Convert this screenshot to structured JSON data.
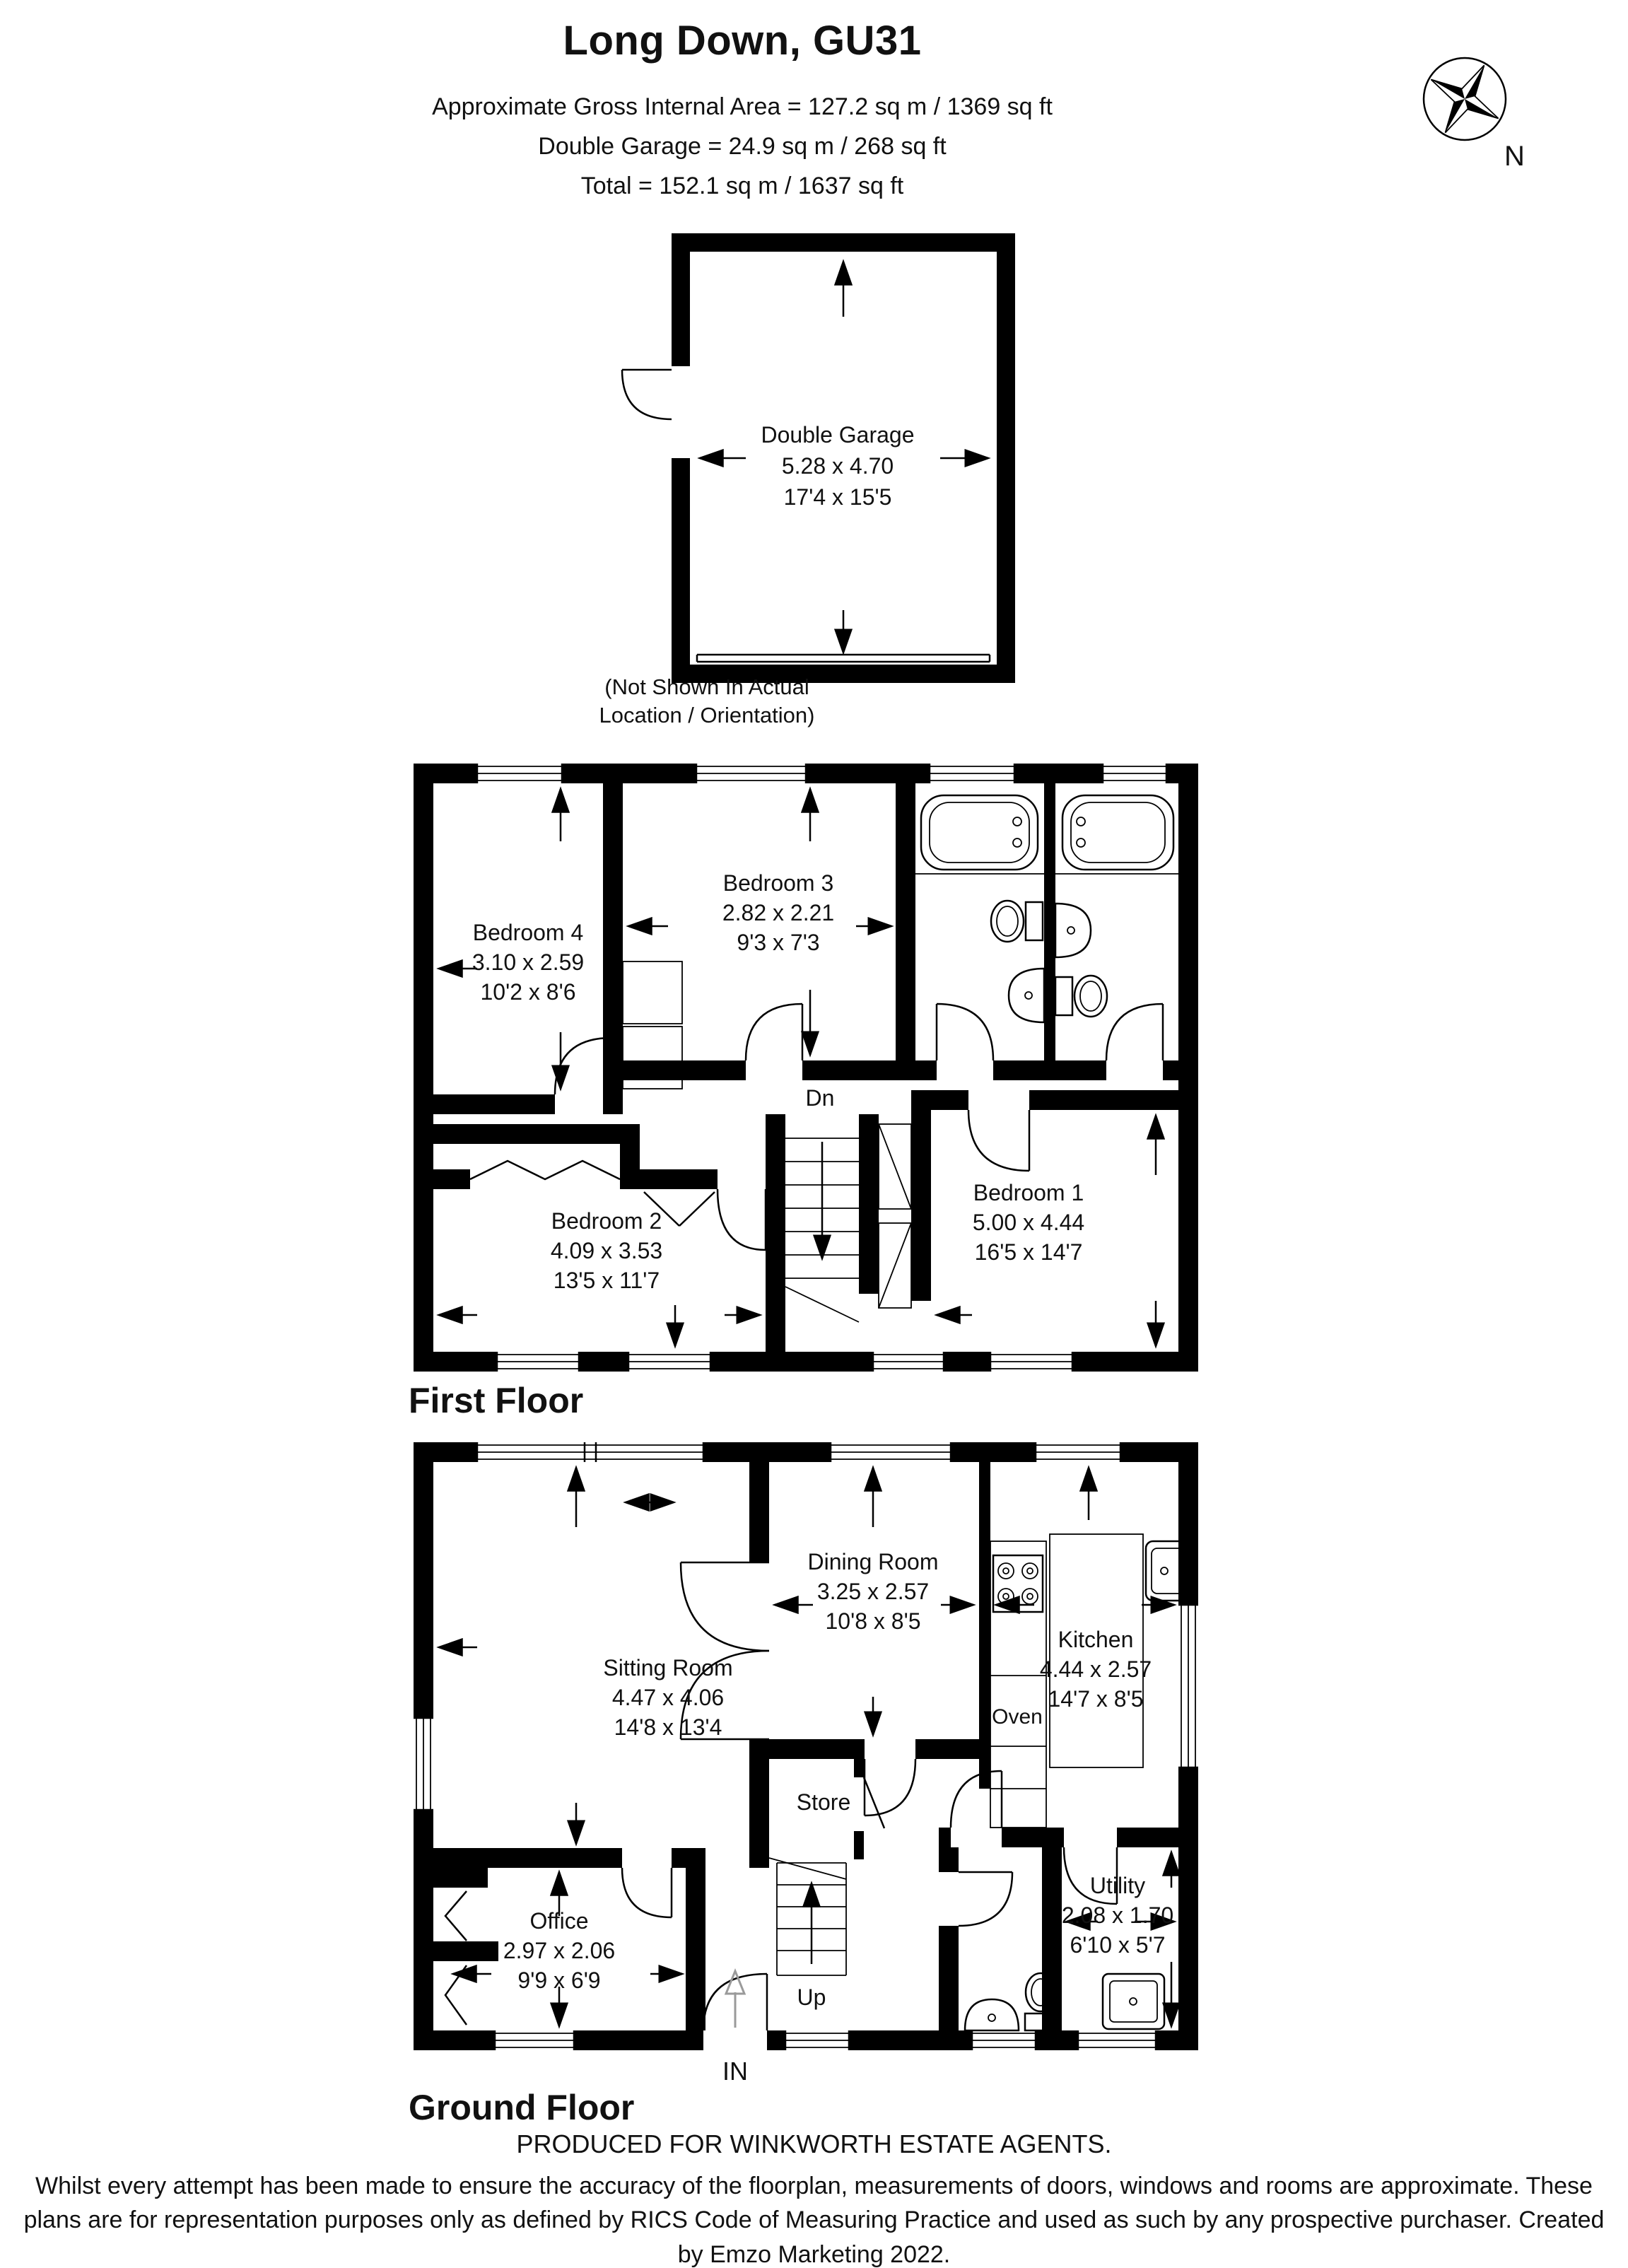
{
  "header": {
    "title": "Long Down, GU31",
    "line1": "Approximate Gross Internal Area = 127.2 sq m / 1369 sq ft",
    "line2": "Double Garage = 24.9 sq m / 268 sq ft",
    "line3": "Total = 152.1 sq m / 1637 sq ft"
  },
  "compass": {
    "label": "N"
  },
  "garage": {
    "name": "Double Garage",
    "metric": "5.28 x 4.70",
    "imperial": "17'4 x 15'5",
    "note": "(Not Shown In Actual Location / Orientation)"
  },
  "first_floor": {
    "label": "First Floor",
    "stairs": "Dn",
    "rooms": {
      "bedroom1": {
        "name": "Bedroom 1",
        "metric": "5.00 x 4.44",
        "imperial": "16'5 x 14'7"
      },
      "bedroom2": {
        "name": "Bedroom 2",
        "metric": "4.09 x 3.53",
        "imperial": "13'5 x 11'7"
      },
      "bedroom3": {
        "name": "Bedroom 3",
        "metric": "2.82 x 2.21",
        "imperial": "9'3 x 7'3"
      },
      "bedroom4": {
        "name": "Bedroom 4",
        "metric": "3.10 x 2.59",
        "imperial": "10'2 x 8'6"
      }
    }
  },
  "ground_floor": {
    "label": "Ground Floor",
    "stairs": "Up",
    "entrance": "IN",
    "rooms": {
      "sitting": {
        "name": "Sitting Room",
        "metric": "4.47 x 4.06",
        "imperial": "14'8 x 13'4"
      },
      "dining": {
        "name": "Dining Room",
        "metric": "3.25 x 2.57",
        "imperial": "10'8 x 8'5"
      },
      "kitchen": {
        "name": "Kitchen",
        "metric": "4.44 x 2.57",
        "imperial": "14'7 x 8'5"
      },
      "office": {
        "name": "Office",
        "metric": "2.97 x 2.06",
        "imperial": "9'9 x 6'9"
      },
      "utility": {
        "name": "Utility",
        "metric": "2.08 x 1.70",
        "imperial": "6'10 x 5'7"
      },
      "store": {
        "name": "Store"
      },
      "oven": {
        "name": "Oven"
      }
    }
  },
  "footer": {
    "line1": "PRODUCED FOR WINKWORTH ESTATE AGENTS.",
    "disclaimer": "Whilst every attempt has been made to ensure the accuracy of the floorplan, measurements of doors, windows and rooms are approximate. These plans are for representation purposes only as defined by RICS Code of Measuring Practice and used as such by any prospective purchaser. Created by Emzo Marketing 2022."
  }
}
